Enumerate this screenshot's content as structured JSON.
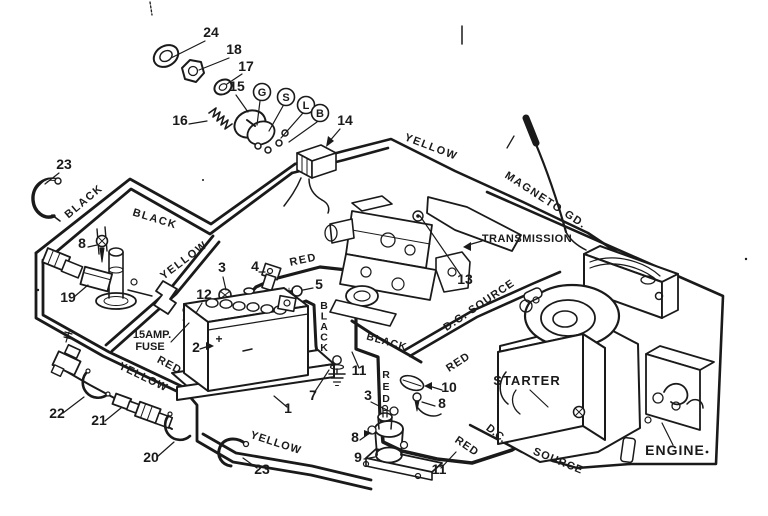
{
  "document": {
    "type": "wiring-diagram",
    "subject": "Riding mower electrical wiring diagram with exploded ignition switch, battery, solenoid, transmission and engine"
  },
  "colors": {
    "ink": "#1a1a1a",
    "paper": "#ffffff"
  },
  "diagram": {
    "labels": [
      {
        "name": "part-24-label",
        "text": "24",
        "x": 211,
        "y": 37,
        "size": 14
      },
      {
        "name": "part-18-label",
        "text": "18",
        "x": 234,
        "y": 54,
        "size": 14
      },
      {
        "name": "part-17-label",
        "text": "17",
        "x": 246,
        "y": 71,
        "size": 14
      },
      {
        "name": "part-15-label",
        "text": "15",
        "x": 237,
        "y": 91,
        "size": 14
      },
      {
        "name": "part-16-label",
        "text": "16",
        "x": 180,
        "y": 125,
        "size": 14
      },
      {
        "name": "terminal-g-label",
        "text": "G",
        "x": 262,
        "y": 96,
        "size": 11
      },
      {
        "name": "terminal-s-label",
        "text": "S",
        "x": 286,
        "y": 101,
        "size": 11
      },
      {
        "name": "terminal-l-label",
        "text": "L",
        "x": 306,
        "y": 109,
        "size": 11
      },
      {
        "name": "terminal-b-label",
        "text": "B",
        "x": 320,
        "y": 117,
        "size": 11
      },
      {
        "name": "part-14-label",
        "text": "14",
        "x": 345,
        "y": 125,
        "size": 14
      },
      {
        "name": "part-23-top-label",
        "text": "23",
        "x": 64,
        "y": 169,
        "size": 14
      },
      {
        "name": "wire-black-1-label",
        "text": "BLACK",
        "x": 86,
        "y": 204,
        "size": 11,
        "rot": -40,
        "ls": 1.5
      },
      {
        "name": "wire-black-2-label",
        "text": "BLACK",
        "x": 154,
        "y": 222,
        "size": 11,
        "rot": 17,
        "ls": 1.5
      },
      {
        "name": "wire-yellow-1-label",
        "text": "YELLOW",
        "x": 186,
        "y": 263,
        "size": 11,
        "rot": -37,
        "ls": 1.5
      },
      {
        "name": "part-8-left-label",
        "text": "8",
        "x": 82,
        "y": 248,
        "size": 14
      },
      {
        "name": "part-19-label",
        "text": "19",
        "x": 68,
        "y": 302,
        "size": 14
      },
      {
        "name": "part-3-top-label",
        "text": "3",
        "x": 222,
        "y": 272,
        "size": 14
      },
      {
        "name": "part-12-label",
        "text": "12",
        "x": 204,
        "y": 299,
        "size": 14
      },
      {
        "name": "part-4-label",
        "text": "4",
        "x": 255,
        "y": 271,
        "size": 14
      },
      {
        "name": "wire-red-top-label",
        "text": "RED",
        "x": 304,
        "y": 263,
        "size": 11,
        "rot": -12,
        "ls": 1.5
      },
      {
        "name": "part-5-label",
        "text": "5",
        "x": 319,
        "y": 289,
        "size": 14
      },
      {
        "name": "fuse-label-line1",
        "text": "15AMP.",
        "x": 152,
        "y": 338,
        "size": 11
      },
      {
        "name": "fuse-label-line2",
        "text": "FUSE",
        "x": 150,
        "y": 350,
        "size": 11
      },
      {
        "name": "part-2-label",
        "text": "2",
        "x": 196,
        "y": 352,
        "size": 14
      },
      {
        "name": "battery-plus-label",
        "text": "+",
        "x": 219,
        "y": 343,
        "size": 12
      },
      {
        "name": "wire-red-left-label",
        "text": "RED",
        "x": 168,
        "y": 368,
        "size": 11,
        "rot": 28,
        "ls": 1
      },
      {
        "name": "wire-yellow-2-label",
        "text": "YELLOW",
        "x": 142,
        "y": 380,
        "size": 11,
        "rot": 26,
        "ls": 1
      },
      {
        "name": "part-22-label",
        "text": "22",
        "x": 57,
        "y": 418,
        "size": 14
      },
      {
        "name": "part-21-label",
        "text": "21",
        "x": 99,
        "y": 425,
        "size": 14
      },
      {
        "name": "part-20-label",
        "text": "20",
        "x": 151,
        "y": 462,
        "size": 14
      },
      {
        "name": "part-1-label",
        "text": "1",
        "x": 288,
        "y": 413,
        "size": 14
      },
      {
        "name": "part-7-label",
        "text": "7",
        "x": 313,
        "y": 400,
        "size": 14
      },
      {
        "name": "part-11-upper-label",
        "text": "11",
        "x": 359,
        "y": 375,
        "size": 14
      },
      {
        "name": "wire-black-vertical-label",
        "text": "BLACK",
        "x": 324,
        "y": 309,
        "size": 10.5,
        "stack": 10.5
      },
      {
        "name": "wire-black-3-label",
        "text": "BLACK",
        "x": 386,
        "y": 345,
        "size": 10.5,
        "rot": 16,
        "ls": 1
      },
      {
        "name": "wire-red-vertical-label",
        "text": "RED",
        "x": 386,
        "y": 378,
        "size": 10.5,
        "stack": 12
      },
      {
        "name": "part-3-mid-label",
        "text": "3",
        "x": 368,
        "y": 400,
        "size": 14
      },
      {
        "name": "part-10-label",
        "text": "10",
        "x": 449,
        "y": 392,
        "size": 14
      },
      {
        "name": "part-8-right-label",
        "text": "8",
        "x": 442,
        "y": 408,
        "size": 14
      },
      {
        "name": "part-8-solenoid-label",
        "text": "8",
        "x": 355,
        "y": 442,
        "size": 14
      },
      {
        "name": "part-9-label",
        "text": "9",
        "x": 358,
        "y": 462,
        "size": 14
      },
      {
        "name": "part-11-lower-label",
        "text": "11",
        "x": 439,
        "y": 474,
        "size": 14
      },
      {
        "name": "part-23-bottom-label",
        "text": "23",
        "x": 262,
        "y": 474,
        "size": 14
      },
      {
        "name": "wire-yellow-3-label",
        "text": "YELLOW",
        "x": 275,
        "y": 446,
        "size": 11,
        "rot": 18,
        "ls": 1
      },
      {
        "name": "wire-red-lower-label",
        "text": "RED",
        "x": 465,
        "y": 449,
        "size": 11,
        "rot": 34,
        "ls": 1
      },
      {
        "name": "part-13-label",
        "text": "13",
        "x": 465,
        "y": 284,
        "size": 14
      },
      {
        "name": "transmission-label",
        "text": "TRANSMISSION",
        "x": 527,
        "y": 242,
        "size": 11,
        "ls": 0.5
      },
      {
        "name": "wire-magneto-gd-label",
        "text": "MAGNETO GD.",
        "x": 544,
        "y": 203,
        "size": 11,
        "rot": 33,
        "ls": 1.5
      },
      {
        "name": "wire-yellow-top-label",
        "text": "YELLOW",
        "x": 430,
        "y": 150,
        "size": 11,
        "rot": 21,
        "ls": 1.5
      },
      {
        "name": "wire-dc-source-upper-label",
        "text": "D.C. SOURCE",
        "x": 481,
        "y": 308,
        "size": 11,
        "rot": -34,
        "ls": 1
      },
      {
        "name": "wire-red-mid-label",
        "text": "RED",
        "x": 460,
        "y": 365,
        "size": 11,
        "rot": -33,
        "ls": 1
      },
      {
        "name": "starter-label",
        "text": "STARTER",
        "x": 527,
        "y": 385,
        "size": 13,
        "ls": 1
      },
      {
        "name": "wire-dc-lower-label",
        "text": "D.C.",
        "x": 494,
        "y": 436,
        "size": 11,
        "rot": 38
      },
      {
        "name": "wire-source-lower-label",
        "text": "SOURCE",
        "x": 557,
        "y": 464,
        "size": 11,
        "rot": 22,
        "ls": 1
      },
      {
        "name": "engine-label",
        "text": "ENGINE",
        "x": 675,
        "y": 455,
        "size": 14,
        "ls": 1
      }
    ]
  }
}
